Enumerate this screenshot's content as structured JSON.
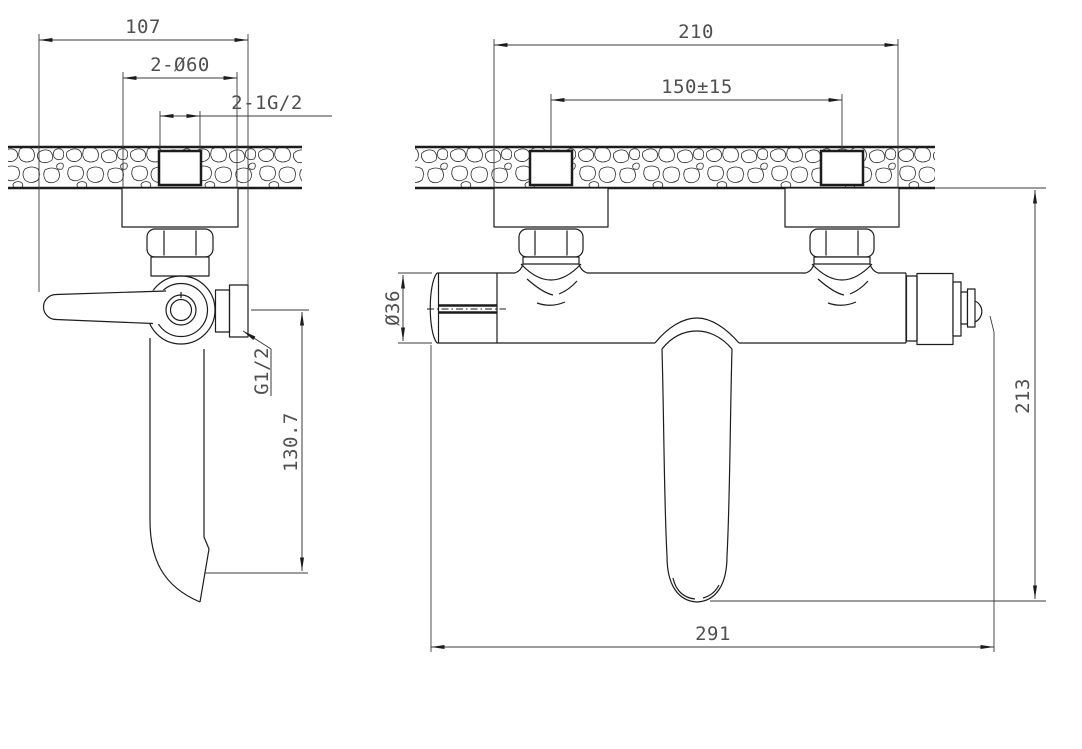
{
  "drawing": {
    "kind": "bath-mixer-installation-dimension-drawing",
    "side_view": {
      "overall_width": "107",
      "escutcheon_dia": "2-Ø60",
      "wall_thread": "2-1G/2",
      "outlet_thread": "G1/2",
      "spout_drop": "130.7"
    },
    "front_view": {
      "overall_span": "210",
      "hole_centers": "150±15",
      "body_dia": "Ø36",
      "drop_below_wall": "213",
      "overall_length": "291"
    },
    "colors": {
      "line": "#1c1c1c",
      "dim_text": "#4f4f4f",
      "background": "#ffffff"
    }
  }
}
